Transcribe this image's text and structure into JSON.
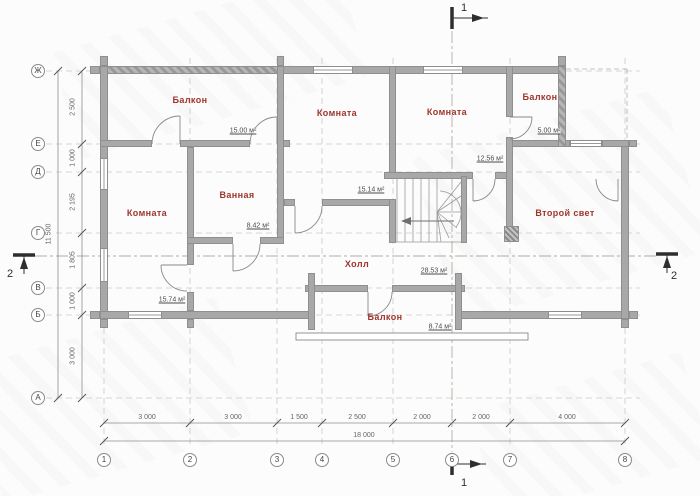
{
  "plan": {
    "rooms": {
      "balcony_top_left": {
        "label": "Балкон",
        "area": "15.00 м²"
      },
      "room_mid_top": {
        "label": "Комната",
        "area": "15.14 м²"
      },
      "room_right_top": {
        "label": "Комната",
        "area": "12.56 м²"
      },
      "balcony_top_right": {
        "label": "Балкон",
        "area": "5.00 м²"
      },
      "room_left": {
        "label": "Комната",
        "area": "15.74 м²"
      },
      "bathroom": {
        "label": "Ванная",
        "area": "8.42 м²"
      },
      "hall": {
        "label": "Холл",
        "area": "28.53 м²"
      },
      "balcony_bottom": {
        "label": "Балкон",
        "area": "8.74 м²"
      },
      "second_light": {
        "label": "Второй свет"
      }
    },
    "axes": {
      "columns": [
        "1",
        "2",
        "3",
        "4",
        "5",
        "6",
        "7",
        "8"
      ],
      "rows": [
        "Ж",
        "Е",
        "Д",
        "Г",
        "В",
        "Б",
        "А"
      ],
      "col_dims": [
        "3 000",
        "3 000",
        "1 500",
        "2 500",
        "2 000",
        "2 000",
        "4 000"
      ],
      "row_dims": [
        "2 500",
        "1 000",
        "2 195",
        "1 805",
        "1 000",
        "3 000"
      ],
      "total_width": "18 000",
      "total_height": "11 500"
    },
    "sections": {
      "one": "1",
      "two": "2"
    },
    "colors": {
      "room_label": "#9e342c",
      "wall": "#a8a8a8",
      "dim_text": "#666666"
    }
  }
}
